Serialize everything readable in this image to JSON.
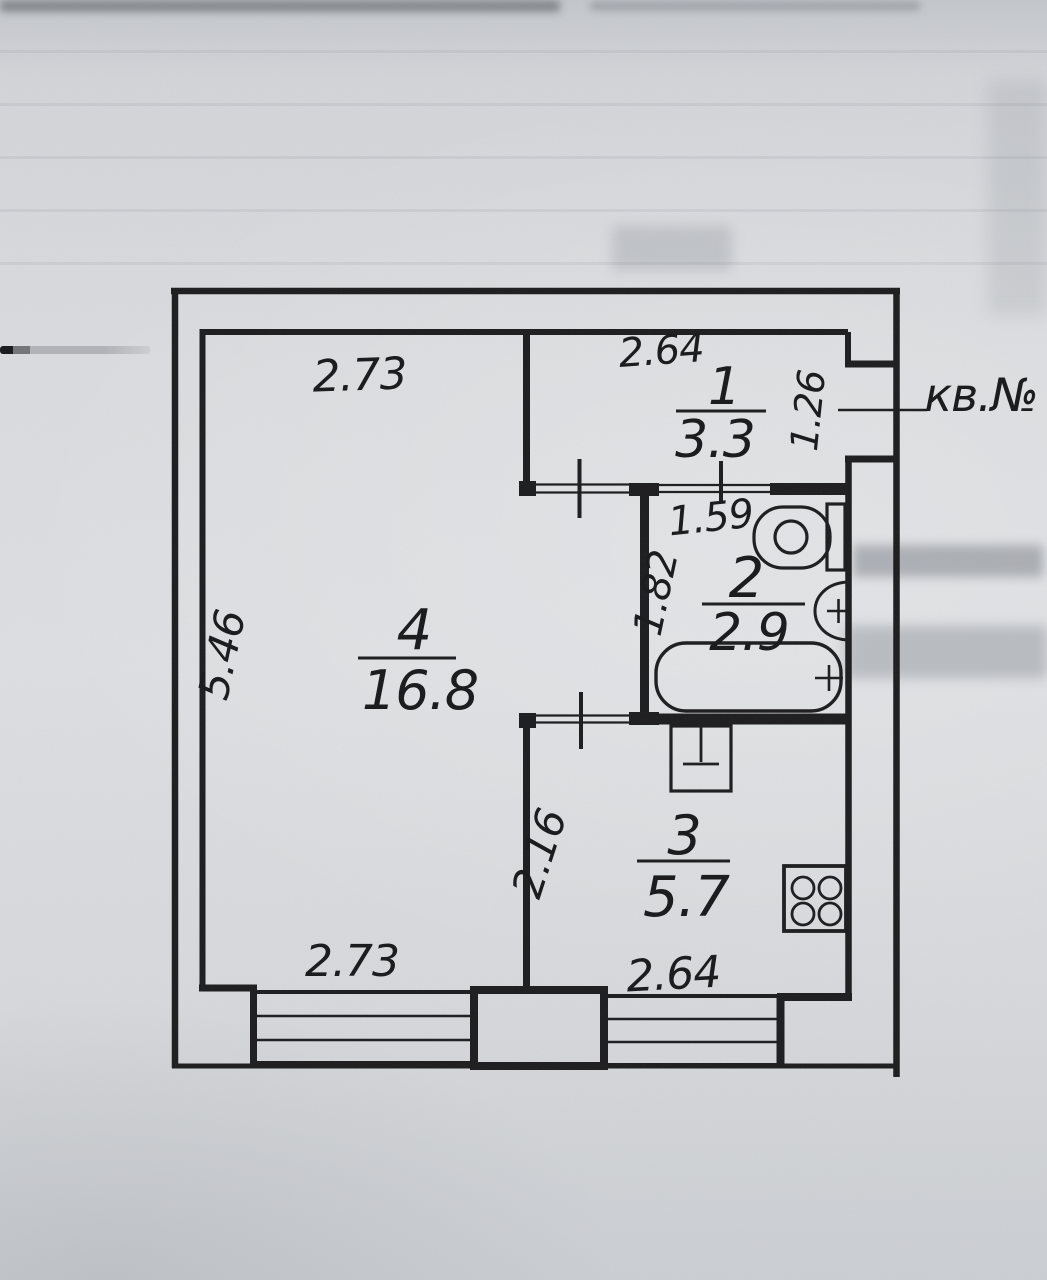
{
  "document": {
    "apartment_no_label": "кв.№"
  },
  "colors": {
    "paper": "#d9dbde",
    "ink": "#1b1b1d"
  },
  "rooms": [
    {
      "number": "1",
      "area": "3.3"
    },
    {
      "number": "2",
      "area": "2.9"
    },
    {
      "number": "3",
      "area": "5.7"
    },
    {
      "number": "4",
      "area": "16.8"
    }
  ],
  "dimensions": {
    "room4_top_width": "2.73",
    "room4_left_height": "5.46",
    "room4_bottom_width": "2.73",
    "hall_top_width": "2.64",
    "hall_right_depth": "1.26",
    "bath_top_width": "1.59",
    "bath_left_height": "1.82",
    "kitchen_left_height": "2.16",
    "kitchen_bottom_width": "2.64"
  },
  "icons": {
    "toilet": "toilet-icon",
    "wash_basin": "basin-icon",
    "bathtub": "bathtub-icon",
    "kitchen_sink": "kitchen-sink-icon",
    "gas_stove": "stove-icon"
  }
}
